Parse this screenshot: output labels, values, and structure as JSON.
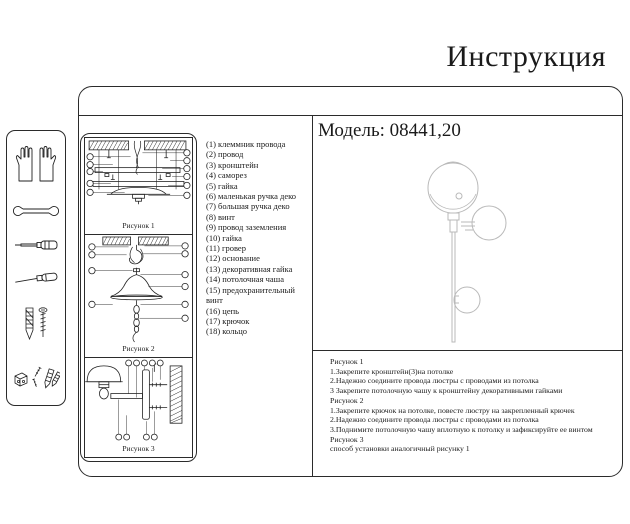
{
  "page": {
    "title": "Инструкция"
  },
  "model": {
    "label": "Модель: 08441,20"
  },
  "sidebar": {
    "icons": [
      "gloves-icon",
      "wrench-icon",
      "screwdriver-icon",
      "awl-icon",
      "anchor-and-screw-icon",
      "fasteners-icon"
    ]
  },
  "figures": [
    {
      "label": "Рисунок 1"
    },
    {
      "label": "Рисунок 2"
    },
    {
      "label": "Рисунок 3"
    }
  ],
  "parts": {
    "items": [
      "(1) клеммник провода",
      "(2) провод",
      "(3) кронштейн",
      "(4) саморез",
      "(5) гайка",
      "(6) маленькая ручка деко",
      "(7) большая ручка деко",
      "(8) винт",
      "(9) провод заземления",
      "(10) гайка",
      "(11) гровер",
      "(12) основание",
      "(13) декоративная гайка",
      "(14) потолочная чаша",
      "(15) предохранительный винт",
      "(16) цепь",
      "(17) крючок",
      "(18) кольцо"
    ]
  },
  "instructions": {
    "lines": [
      "Рисунок 1",
      "1.Закрепите кронштейн(3)на потолке",
      "2.Надежно соедините провода люстры с проводами из потолка",
      "3 Закрепите потолочную чашу к кронштейну декоративными гайками",
      "Рисунок 2",
      "1.Закрепите крючок на потолке, повесте люстру на закрепленный крючек",
      "2.Надежно соедините провода люстры с проводами из потолка",
      "3.Поднимите потолочную чашу вплотную к потолку и зафиксируйте ее винтом",
      "Рисунок 3",
      "способ установки аналогичный рисунку 1"
    ]
  }
}
